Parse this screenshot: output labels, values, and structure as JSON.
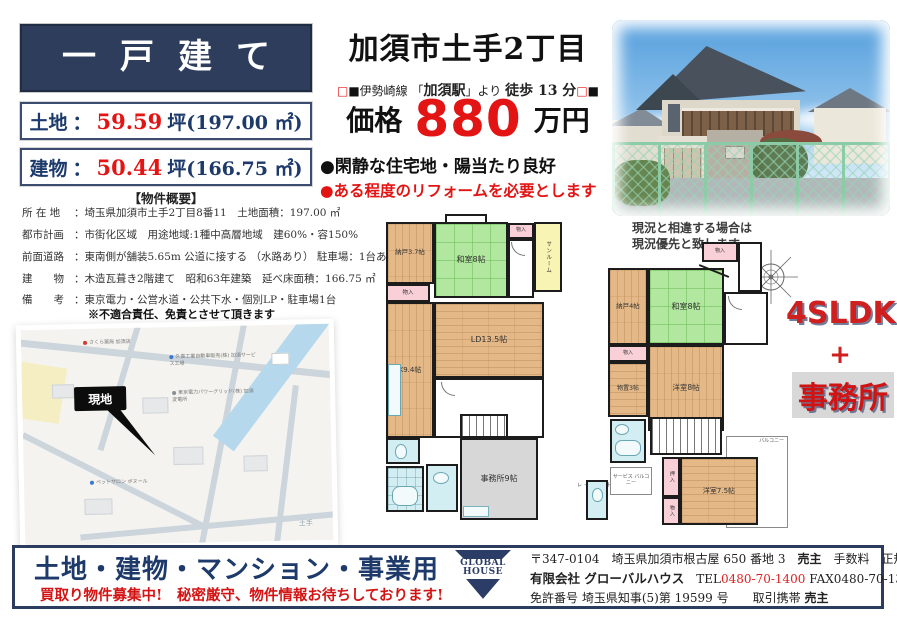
{
  "header": {
    "property_type": "一戸建て",
    "land_label": "土地",
    "land_sep": "：",
    "land_number": "59.59",
    "land_rest": "坪(197.00 ㎡)",
    "building_label": "建物",
    "building_sep": "：",
    "building_number": "50.44",
    "building_rest": "坪(166.75 ㎡)",
    "overview_title": "【物件概要】"
  },
  "headline": {
    "location": "加須市土手2丁目",
    "sq_outline": "□",
    "sq_solid": "■",
    "access_pre": "伊勢崎線 「",
    "access_station": "加須駅",
    "access_mid": "」より ",
    "access_walk": "徒歩 13 分",
    "price_label": "価格",
    "price_value": "880",
    "price_unit": "万円",
    "feature": "●閑静な住宅地・陽当たり良好",
    "warning": "●ある程度のリフォームを必要とします"
  },
  "overview": {
    "rows": [
      {
        "label": "所 在 地",
        "value": "：埼玉県加須市土手2丁目8番11　土地面積：197.00 ㎡"
      },
      {
        "label": "都市計画",
        "value": "：市街化区域　用途地域:1種中高層地域　建60%・容150%"
      },
      {
        "label": "前面道路",
        "value": "：東南側が舗装5.65m 公道に接する （水路あり） 駐車場：1台あり"
      },
      {
        "label": "建　　物",
        "value": "：木造瓦葺き2階建て　昭和63年建築　延べ床面積：166.75 ㎡"
      },
      {
        "label": "備　　考",
        "value": "：東京電力・公営水道・公共下水・個別LP・駐車場1台"
      }
    ],
    "disclaimer": "※不適合責任、免責とさせて頂きます"
  },
  "map": {
    "site": "現地",
    "pharmacy": "さくら薬局 加須店",
    "factory": "久喜工業自動車販売(株) 加須サービス工場",
    "power": "東京電力パワーグリッド(株) 加須変電所",
    "pet": "ペットサロン ボヌール",
    "district": "土手"
  },
  "floorplan": {
    "note_line1": "現況と相違する場合は",
    "note_line2": "現況優先と致します",
    "closet": "物入",
    "oshiire": "押入",
    "f1": {
      "nando": "納戸3.7帖",
      "washitsu": "和室8帖",
      "sunroom": "サンルーム",
      "kitchen": "K9.4帖",
      "living": "LD13.5帖",
      "office": "事務所9帖",
      "ext_toilet": "外部トイレ"
    },
    "f2": {
      "nando": "納戸4帖",
      "washitsu": "和室8帖",
      "storeroom": "物置3帖",
      "western8": "洋室8帖",
      "western75": "洋室7.5帖",
      "service_balcony": "サービス バルコニー",
      "balcony": "バルコニー"
    },
    "badge": {
      "line1": "4SLDK",
      "line2": "+",
      "line3": "事務所"
    }
  },
  "footer": {
    "promo_title": "土地・建物・マンション・事業用",
    "promo_sub": "買取り物件募集中!　秘密厳守、物件情報お待ちしております!",
    "logo_line1": "GLOBAL",
    "logo_line2": "HOUSE",
    "address": "〒347-0104　埼玉県加須市根古屋 650 番地 3",
    "seller": "売主",
    "fee": "手数料　正規報酬",
    "company": "有限会社 グローバルハウス",
    "tel_label": "TEL",
    "tel_number": "0480-70-1400",
    "fax": "FAX0480-70-1399",
    "license": "免許番号 埼玉県知事(5)第 19599 号",
    "deal_label": "取引携帯",
    "deal_value": "売主"
  }
}
